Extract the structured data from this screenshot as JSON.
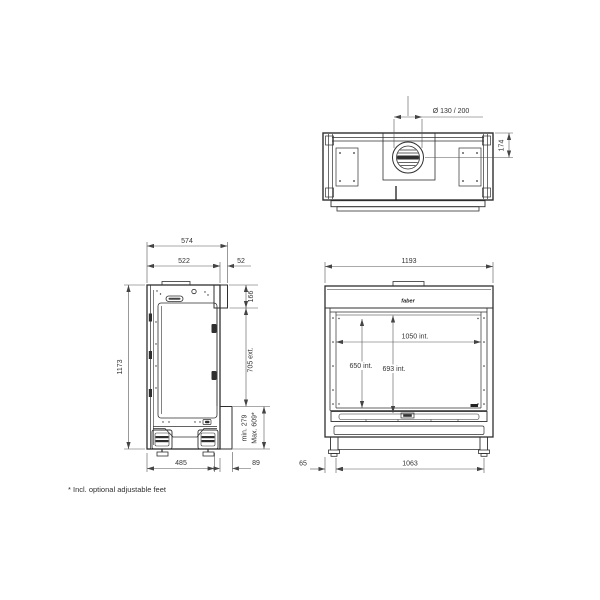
{
  "drawing_type": "fireplace technical drawing, three orthographic views",
  "footnote": "* Incl. optional adjustable feet",
  "brand": "faber",
  "top_view": {
    "flue_diameter": "Ø 130 / 200",
    "flue_center_offset": "174"
  },
  "side_view": {
    "depth_total": "574",
    "depth_body": "522",
    "front_section_depth": "52",
    "height_total": "1173",
    "front_glass_height": "166",
    "exterior_height": "705 ext.",
    "base_min_height": "min. 279",
    "base_max_height": "Max. 609*",
    "base_depth": "485",
    "front_panel_depth": "89"
  },
  "front_view": {
    "width_total": "1193",
    "interior_width": "1050 int.",
    "glass_interior_height": "650 int.",
    "interior_height": "693 int.",
    "feet_span": "1063",
    "foot_inset": "65"
  }
}
